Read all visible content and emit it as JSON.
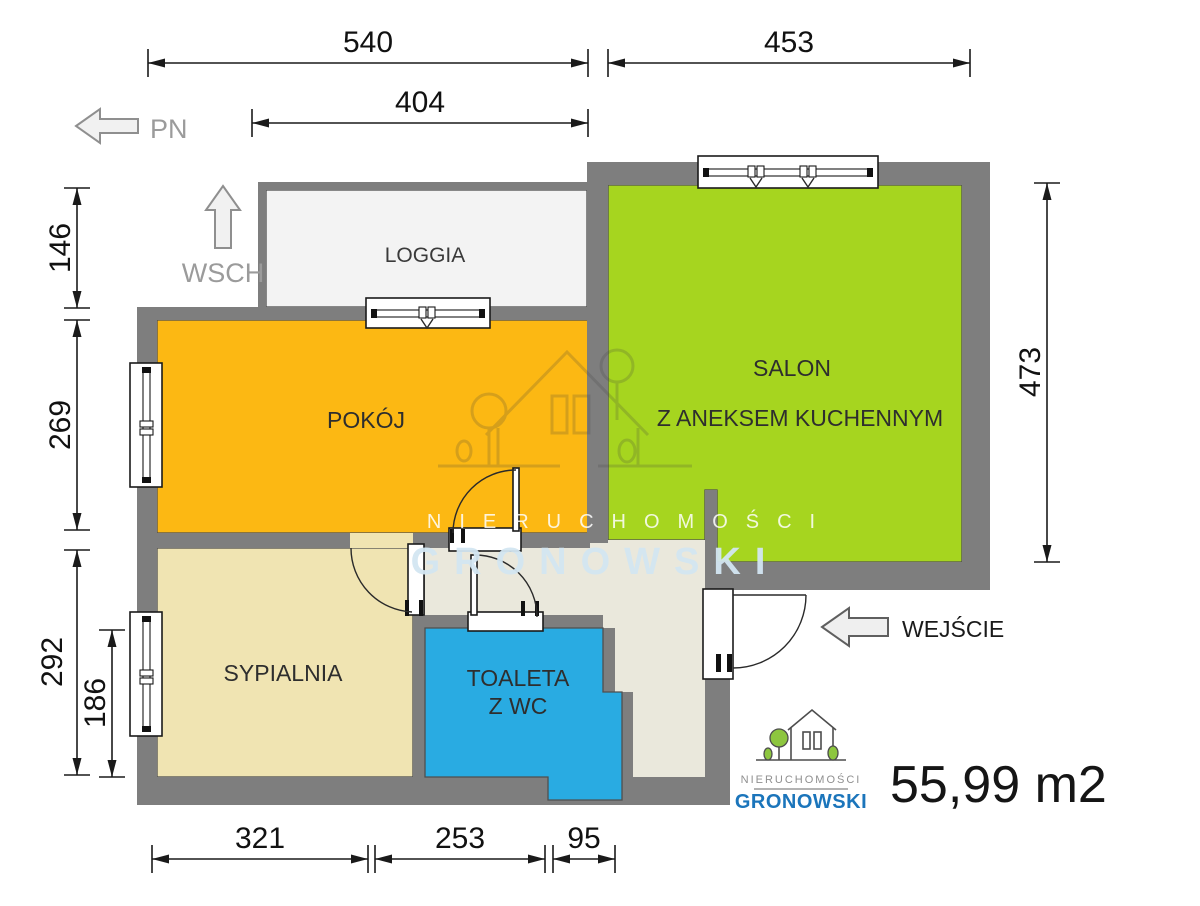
{
  "compass": {
    "north": "PN",
    "east": "WSCH"
  },
  "entrance": {
    "label": "WEJŚCIE"
  },
  "area": {
    "label": "55,99 m2"
  },
  "rooms": {
    "loggia": {
      "label": "LOGGIA"
    },
    "pokoj": {
      "label": "POKÓJ"
    },
    "salon": {
      "line1": "SALON",
      "line2": "Z ANEKSEM KUCHENNYM"
    },
    "sypialnia": {
      "label": "SYPIALNIA"
    },
    "toaleta": {
      "line1": "TOALETA",
      "line2": "Z WC"
    }
  },
  "dimensions_cm": {
    "top_left": "540",
    "top_right": "453",
    "loggia_width": "404",
    "loggia_depth": "146",
    "pokoj_height": "269",
    "sypialnia_height": "292",
    "sypialnia_window": "186",
    "salon_height": "473",
    "bottom_sypialnia": "321",
    "bottom_toaleta": "253",
    "bottom_hall": "95"
  },
  "watermark": {
    "top": "NIERUCHOMOŚCI",
    "main": "GRONOWSKI"
  },
  "logo": {
    "top": "NIERUCHOMOŚCI",
    "main": "GRONOWSKI"
  },
  "colors": {
    "wall": "#7e7e7e",
    "pokoj": "#fcb813",
    "salon": "#a6d51f",
    "sypialnia": "#f0e4b2",
    "toaleta": "#29abe2",
    "hall": "#eae8dc",
    "loggia": "#f3f3f3",
    "logo_blue": "#1b75bb",
    "watermark_blue": "#d3e6f2"
  }
}
